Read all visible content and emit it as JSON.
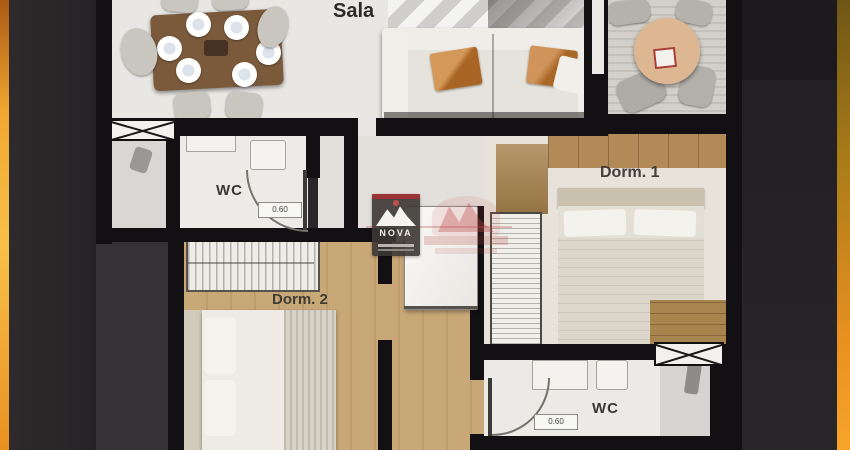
{
  "labels": {
    "sala": "Sala",
    "wc_top": "WC",
    "wc_top_dim": "0.60",
    "dorm1": "Dorm. 1",
    "dorm2": "Dorm. 2",
    "wc_bottom": "WC",
    "wc_bottom_dim": "0.60"
  },
  "watermark": {
    "nova": "NOVA"
  },
  "colors": {
    "background": "#2a272a",
    "left_accent": "#f0a830",
    "right_accent": "#e89020",
    "wall": "#131013",
    "white_floor": "#e9e7e3",
    "wood_floor": "#c9a878",
    "deck_floor": "#d2cfc8",
    "watermark_red": "#b84848"
  }
}
